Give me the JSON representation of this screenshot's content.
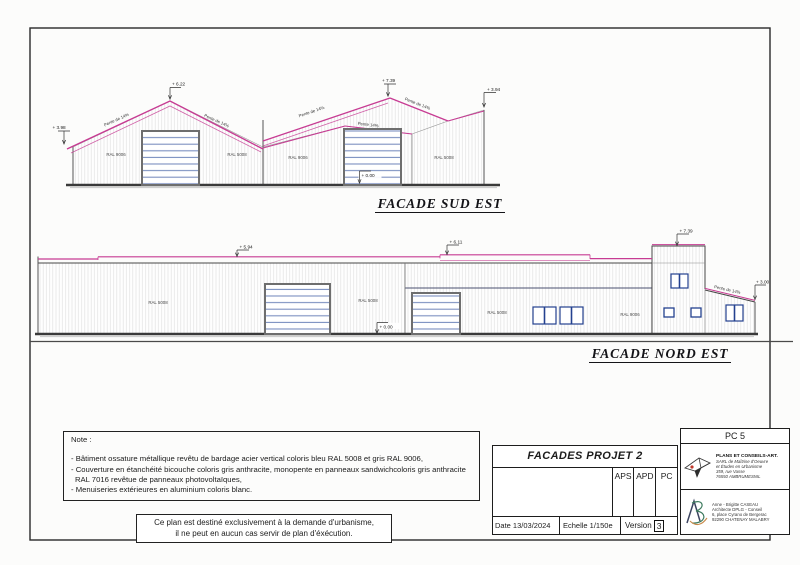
{
  "colors": {
    "roof_pink": "#c73b93",
    "ink": "#3a3a3a",
    "door_slat": "#7b8fc0",
    "window_frame": "#24418f"
  },
  "fse": {
    "title": "FACADE SUD EST",
    "dims": {
      "eave_left": "+ 3.98",
      "peak_left": "+ 6.22",
      "peak_right": "+ 7.39",
      "eave_right": "+ 3.94",
      "level_zero": "+ 0.00"
    },
    "slopes": {
      "s1": "Pente de 14%",
      "s2": "Pente de 14%",
      "s3": "Pente de 14%",
      "s4": "Pente 14%",
      "s5": "Pente de 14%"
    },
    "ral": [
      "RAL 9006",
      "RAL 5008",
      "RAL 9006",
      "RAL 5008"
    ]
  },
  "fne": {
    "title": "FACADE NORD EST",
    "dims": {
      "d594": "+ 5.94",
      "d611": "+ 6.11",
      "d739": "+ 7.39",
      "d300": "+ 3.00",
      "level_zero": "+ 0.00"
    },
    "slope": "Pente de 14%",
    "ral": [
      "RAL 5008",
      "RAL 5008",
      "RAL 5008",
      "RAL 9006"
    ]
  },
  "note": {
    "heading": "Note :",
    "items": [
      "- Bâtiment ossature métallique revêtu de bardage acier vertical coloris bleu RAL 5008 et gris RAL 9006,",
      "- Couverture en étanchéité bicouche coloris gris anthracite, monopente en panneaux sandwichcoloris gris anthracite RAL 7016 revêtue de panneaux photovoltaïques,",
      "- Menuiseries extérieures en aluminium coloris blanc."
    ]
  },
  "warning": {
    "line1": "Ce plan est destiné exclusivement à la demande d'urbanisme,",
    "line2": "il ne peut en aucun cas servir de plan d'éxécution."
  },
  "titleblock": {
    "sheet": "PC 5",
    "project": "FACADES PROJET 2",
    "phases": [
      "APS",
      "APD",
      "PC"
    ],
    "date": "Date 13/03/2024",
    "scale": "Echelle 1/150e",
    "version_label": "Version",
    "version_value": "3",
    "firm": {
      "name": "PLANS ET CONSEILS-ART.",
      "lines": [
        "SARL de Maîtrise d'Oeuvre",
        "et Études en Urbanisme",
        "359, rue Vasse",
        "76550 AMBRUMESNIL"
      ]
    },
    "architect": {
      "lines": [
        "Anne - Brigitte CASEAU",
        "Architecte DPLG - Conseil",
        "6, place Cyrano de Bergerac",
        "92290 CHATENAY MALABRY"
      ]
    }
  }
}
